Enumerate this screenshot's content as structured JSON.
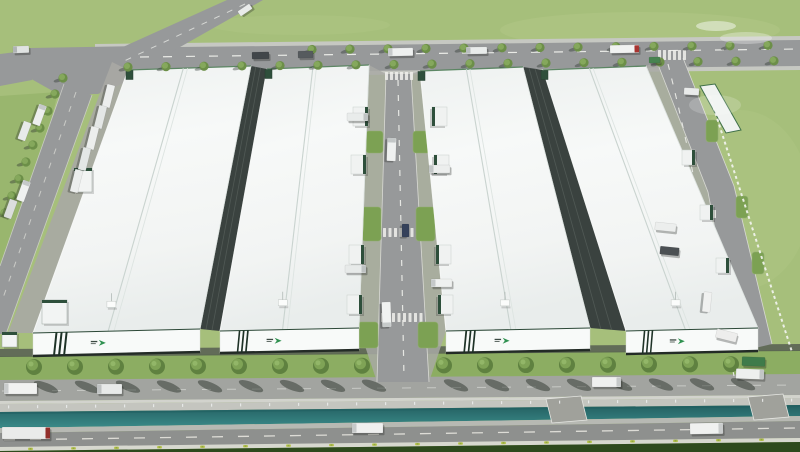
{
  "scene": {
    "type": "aerial-architectural-rendering",
    "subject": "Bird's-eye 3D rendering of an industrial logistics park: four long white-roofed warehouses with green-striped facades, internal dock roads, tree-lined boulevard, canal and perimeter roads with trucks",
    "buildings_count": 4
  },
  "colors": {
    "grass": "#a6bf7b",
    "grass_dark": "#94b269",
    "grass_deep": "#2e4a1d",
    "green_strip": "#8cad62",
    "patch_green": "#7ca153",
    "road": "#97999a",
    "road_dark": "#8e908e",
    "road_light": "#a2a4a0",
    "curb": "#c6c8c2",
    "marking": "#e9eae6",
    "sidewalk": "#d2d3cd",
    "wall": "#c4c5bf",
    "canal_edge": "#b7b9b3",
    "pad": "#a0a19b",
    "roof": "#f2f4f3",
    "facade": "#f8faf9",
    "stripe": "#1e3227",
    "brand_green": "#2f9150",
    "dock_green": "#2e4f3b",
    "apron": "#a8a9a4",
    "gap_wall": "#3a423f",
    "truck_white": "#eff1f0",
    "truck_red": "#a83430",
    "truck_green": "#478350",
    "bush": "#b9c554",
    "tree": "#5f8140",
    "tree_light": "#7fa356",
    "tree_small": "#6c8f48",
    "tree_small_light": "#85a85c"
  },
  "buildings": [
    {
      "name": "warehouse-1",
      "roof": [
        128,
        70,
        251,
        66,
        200,
        329,
        33,
        333
      ],
      "facade": [
        33,
        333,
        200,
        329,
        200,
        352,
        33,
        356
      ]
    },
    {
      "name": "warehouse-2",
      "roof": [
        267,
        69,
        369,
        65,
        359,
        328,
        220,
        331
      ],
      "facade": [
        220,
        331,
        359,
        328,
        359,
        350,
        220,
        353
      ]
    },
    {
      "name": "warehouse-3",
      "roof": [
        420,
        71,
        523,
        67,
        590,
        328,
        446,
        331
      ],
      "facade": [
        446,
        331,
        590,
        328,
        590,
        350,
        446,
        353
      ]
    },
    {
      "name": "warehouse-4",
      "roof": [
        543,
        70,
        646,
        66,
        758,
        328,
        626,
        331
      ],
      "facade": [
        626,
        331,
        758,
        328,
        758,
        351,
        626,
        354
      ]
    }
  ],
  "gap_walls": [
    [
      251,
      66,
      267,
      69,
      220,
      331,
      200,
      329
    ],
    [
      523,
      67,
      543,
      70,
      626,
      331,
      590,
      328
    ]
  ],
  "tree_rows": [
    {
      "name": "boulevard-trees",
      "size": "large",
      "y0": 367,
      "slope": -0.004,
      "xs": [
        34,
        75,
        116,
        157,
        198,
        239,
        280,
        321,
        362,
        444,
        485,
        526,
        567,
        608,
        649,
        690,
        731
      ]
    },
    {
      "name": "north-road-trees-south",
      "size": "small",
      "y0": 67,
      "slope": -0.0095,
      "xs": [
        128,
        166,
        204,
        242,
        280,
        318,
        356,
        394,
        432,
        470,
        508,
        546,
        584,
        622,
        660,
        698,
        736,
        774
      ]
    },
    {
      "name": "north-road-trees-north",
      "size": "small",
      "y0": 49.5,
      "slope": -0.009,
      "xs": [
        312,
        350,
        388,
        426,
        464,
        502,
        540,
        578,
        616,
        654,
        692,
        730,
        768
      ]
    },
    {
      "name": "approach-road-trees",
      "size": "small",
      "pts": [
        [
          63,
          78
        ],
        [
          55,
          94
        ],
        [
          48,
          111
        ],
        [
          40,
          128
        ],
        [
          33,
          145
        ],
        [
          26,
          162
        ],
        [
          19,
          179
        ],
        [
          12,
          196
        ],
        [
          5,
          213
        ]
      ]
    }
  ],
  "vehicles": [
    {
      "x": 252,
      "y": 52,
      "w": 17,
      "h": 7,
      "rot": -1,
      "body": "#41464a"
    },
    {
      "x": 298,
      "y": 51,
      "w": 15,
      "h": 7,
      "rot": -1,
      "body": "#565b5e"
    },
    {
      "x": 388,
      "y": 48,
      "w": 25,
      "h": 8,
      "rot": -1,
      "body": "#eef0ef",
      "cab": "#c7cacb",
      "cab_side": "left"
    },
    {
      "x": 466,
      "y": 47,
      "w": 21,
      "h": 7,
      "rot": -1,
      "body": "#e9eceb",
      "cab": "#b9bdbe",
      "cab_side": "left"
    },
    {
      "x": 610,
      "y": 45,
      "w": 29,
      "h": 8,
      "rot": -1,
      "body": "#f1f2f1",
      "cab": "#a83430",
      "cab_side": "right"
    },
    {
      "x": 649,
      "y": 57,
      "w": 11,
      "h": 6,
      "rot": -1,
      "body": "#478350"
    },
    {
      "x": 13,
      "y": 46,
      "w": 16,
      "h": 7,
      "rot": -2,
      "body": "#e0e3e2",
      "cab": "#b0b4b5",
      "cab_side": "left"
    },
    {
      "x": 238,
      "y": 7,
      "w": 14,
      "h": 6,
      "rot": -34,
      "body": "#e9ebea"
    },
    {
      "x": 29,
      "y": 111,
      "w": 21,
      "h": 8,
      "rot": 110,
      "body": "#edefee",
      "cab": "#c5c9c9",
      "cab_side": "left"
    },
    {
      "x": 15,
      "y": 127,
      "w": 19,
      "h": 8,
      "rot": 110,
      "body": "#e7eae9"
    },
    {
      "x": 13,
      "y": 187,
      "w": 21,
      "h": 8,
      "rot": 110,
      "body": "#eff1f0",
      "cab": "#c5c9c9",
      "cab_side": "left"
    },
    {
      "x": 1,
      "y": 205,
      "w": 19,
      "h": 8,
      "rot": 110,
      "body": "#dbdedd"
    },
    {
      "x": 97,
      "y": 92,
      "w": 23,
      "h": 8,
      "rot": 104,
      "body": "#eceeed"
    },
    {
      "x": 89,
      "y": 113,
      "w": 23,
      "h": 8,
      "rot": 104,
      "body": "#e4e7e6"
    },
    {
      "x": 81,
      "y": 134,
      "w": 23,
      "h": 8,
      "rot": 104,
      "body": "#eceeed"
    },
    {
      "x": 73,
      "y": 155,
      "w": 23,
      "h": 8,
      "rot": 104,
      "body": "#e4e7e6"
    },
    {
      "x": 65,
      "y": 177,
      "w": 23,
      "h": 8,
      "rot": 104,
      "body": "#eceeed"
    },
    {
      "x": 380,
      "y": 145,
      "w": 23,
      "h": 9,
      "rot": 92,
      "body": "#eff1f0",
      "cab": "#c3c7c7",
      "cab_side": "left"
    },
    {
      "x": 399,
      "y": 227,
      "w": 13,
      "h": 7,
      "rot": 90,
      "body": "#35415a"
    },
    {
      "x": 374,
      "y": 310,
      "w": 25,
      "h": 9,
      "rot": 88,
      "body": "#f0f2f1",
      "cab": "#c6caca",
      "cab_side": "right"
    },
    {
      "x": 347,
      "y": 113,
      "w": 21,
      "h": 8,
      "rot": 0,
      "body": "#e9eceb",
      "cab": "#bfc3c3",
      "cab_side": "right"
    },
    {
      "x": 429,
      "y": 165,
      "w": 21,
      "h": 8,
      "rot": 0,
      "body": "#eceeed",
      "cab": "#c2c6c6",
      "cab_side": "left"
    },
    {
      "x": 345,
      "y": 265,
      "w": 21,
      "h": 8,
      "rot": 0,
      "body": "#e7eae9",
      "cab": "#bdc1c1",
      "cab_side": "right"
    },
    {
      "x": 431,
      "y": 279,
      "w": 21,
      "h": 8,
      "rot": 0,
      "body": "#eff1f0",
      "cab": "#c5c9c9",
      "cab_side": "left"
    },
    {
      "x": 655,
      "y": 223,
      "w": 21,
      "h": 8,
      "rot": 6,
      "body": "#eceeed"
    },
    {
      "x": 660,
      "y": 247,
      "w": 19,
      "h": 8,
      "rot": 6,
      "body": "#4b5053"
    },
    {
      "x": 697,
      "y": 298,
      "w": 20,
      "h": 8,
      "rot": 96,
      "body": "#f0f1f0"
    },
    {
      "x": 684,
      "y": 88,
      "w": 15,
      "h": 7,
      "rot": 3,
      "body": "#e9ebea"
    },
    {
      "x": 4,
      "y": 383,
      "w": 33,
      "h": 11,
      "rot": 0,
      "body": "#f1f2f1",
      "cab": "#c9cccc",
      "cab_side": "left"
    },
    {
      "x": 97,
      "y": 384,
      "w": 25,
      "h": 10,
      "rot": 0,
      "body": "#e8eae9",
      "cab": "#c0c3c3",
      "cab_side": "left"
    },
    {
      "x": 592,
      "y": 377,
      "w": 29,
      "h": 10,
      "rot": 0,
      "body": "#eff0ef",
      "cab": "#c6c9c9",
      "cab_side": "right"
    },
    {
      "x": 736,
      "y": 369,
      "w": 28,
      "h": 10,
      "rot": 2,
      "body": "#edefee",
      "cab": "#c3c6c6",
      "cab_side": "right"
    },
    {
      "x": 742,
      "y": 357,
      "w": 23,
      "h": 9,
      "rot": 2,
      "body": "#3f7b4a"
    },
    {
      "x": 716,
      "y": 331,
      "w": 21,
      "h": 9,
      "rot": 14,
      "body": "#ededec"
    },
    {
      "x": 2,
      "y": 427,
      "w": 48,
      "h": 12,
      "rot": 0,
      "body": "#eaebea",
      "cab": "#922f2b",
      "cab_side": "right"
    },
    {
      "x": 352,
      "y": 423,
      "w": 31,
      "h": 10,
      "rot": 0,
      "body": "#eff0ef",
      "cab": "#c6c9c9",
      "cab_side": "left"
    },
    {
      "x": 690,
      "y": 423,
      "w": 33,
      "h": 11,
      "rot": -1,
      "body": "#f0f1f0",
      "cab": "#c9cccc",
      "cab_side": "right"
    }
  ],
  "dock_bays": [
    {
      "x": 353,
      "y": 107,
      "w": 15,
      "h": 19,
      "side": "right"
    },
    {
      "x": 432,
      "y": 107,
      "w": 15,
      "h": 19,
      "side": "left"
    },
    {
      "x": 351,
      "y": 155,
      "w": 15,
      "h": 19,
      "side": "right"
    },
    {
      "x": 434,
      "y": 155,
      "w": 15,
      "h": 19,
      "side": "left"
    },
    {
      "x": 349,
      "y": 245,
      "w": 15,
      "h": 19,
      "side": "right"
    },
    {
      "x": 436,
      "y": 245,
      "w": 15,
      "h": 19,
      "side": "left"
    },
    {
      "x": 347,
      "y": 295,
      "w": 15,
      "h": 19,
      "side": "right"
    },
    {
      "x": 438,
      "y": 295,
      "w": 15,
      "h": 19,
      "side": "left"
    },
    {
      "x": 682,
      "y": 150,
      "w": 13,
      "h": 15,
      "side": "right"
    },
    {
      "x": 700,
      "y": 205,
      "w": 13,
      "h": 15,
      "side": "right"
    },
    {
      "x": 716,
      "y": 258,
      "w": 13,
      "h": 15,
      "side": "right"
    }
  ],
  "grass_patches": [
    {
      "x": 366,
      "y": 131,
      "w": 17,
      "h": 22
    },
    {
      "x": 413,
      "y": 131,
      "w": 17,
      "h": 22
    },
    {
      "x": 362,
      "y": 207,
      "w": 19,
      "h": 34
    },
    {
      "x": 416,
      "y": 207,
      "w": 19,
      "h": 34
    },
    {
      "x": 358,
      "y": 322,
      "w": 20,
      "h": 26
    },
    {
      "x": 418,
      "y": 322,
      "w": 20,
      "h": 26
    },
    {
      "x": 706,
      "y": 120,
      "w": 12,
      "h": 22
    },
    {
      "x": 736,
      "y": 196,
      "w": 12,
      "h": 22
    },
    {
      "x": 752,
      "y": 252,
      "w": 12,
      "h": 22
    }
  ],
  "small_structures": [
    {
      "type": "canopy",
      "x": 74,
      "y": 168,
      "w": 18,
      "h": 24
    },
    {
      "type": "gatehouse",
      "x": 42,
      "y": 300,
      "w": 25,
      "h": 24
    },
    {
      "type": "gatehouse",
      "x": 2,
      "y": 332,
      "w": 15,
      "h": 15
    },
    {
      "type": "long-canopy",
      "pts": "700,86 715,84 741,130 726,133"
    }
  ],
  "crosswalks": [
    {
      "x": 385,
      "y": 72,
      "count": 6,
      "step": 5,
      "bw": 3,
      "bh": 8
    },
    {
      "x": 383,
      "y": 228,
      "count": 7,
      "step": 5.5,
      "bw": 3,
      "bh": 9
    },
    {
      "x": 381,
      "y": 313,
      "count": 8,
      "step": 5.5,
      "bw": 3,
      "bh": 9
    },
    {
      "x": 658,
      "y": 50,
      "count": 6,
      "step": 5,
      "bw": 3,
      "bh": 10
    },
    {
      "x": 688,
      "y": 210,
      "count": 6,
      "step": 5,
      "bw": 3,
      "bh": 8
    }
  ],
  "canal_posts": {
    "x0": 8,
    "step": 29,
    "count": 28,
    "y0": 405.5,
    "slope": -0.00875
  },
  "bushes": {
    "x0": 28,
    "step": 43,
    "count": 18,
    "y0": 448,
    "slope": -0.0125
  }
}
